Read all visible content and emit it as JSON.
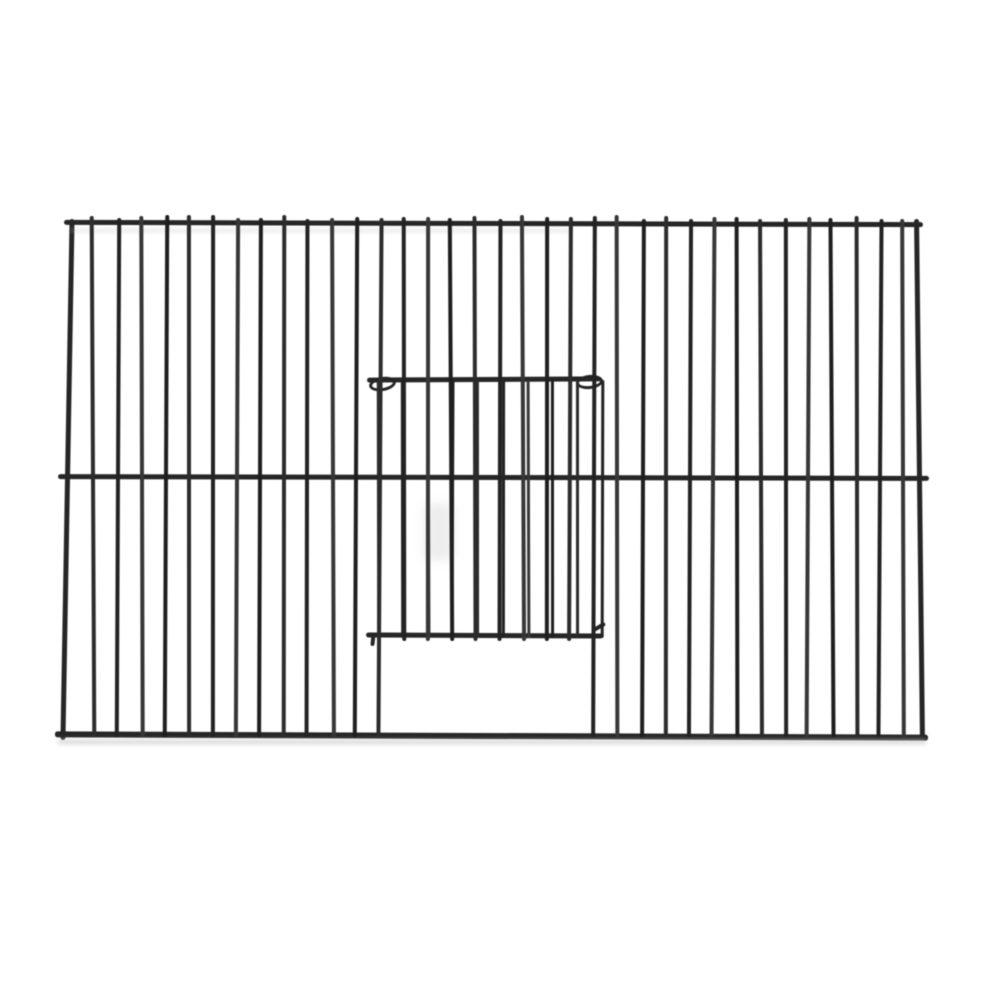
{
  "scene": {
    "description": "Black powder-coated wire bird cage front panel with sliding door, product photo on plain white background",
    "background": "#ffffff",
    "wire_palette": [
      "#1f1f1f",
      "#2c2c2c",
      "#232323",
      "#373737"
    ],
    "shadow_color": "#c9c9c9",
    "ghost_color": "#b5b5b5",
    "patch_color": "#dcdcdc"
  },
  "cage": {
    "top_rail": {
      "x": 64,
      "y": 221,
      "w": 859,
      "h": 5,
      "rot": 0.15
    },
    "bottom_rail": {
      "x": 55,
      "y": 733,
      "w": 873,
      "h": 6,
      "rot": 0.22
    },
    "left_frame": {
      "x": 65,
      "y": 219,
      "w": 5,
      "h": 521,
      "rot": 1.0
    },
    "right_frame": {
      "x": 917,
      "y": 219,
      "w": 5,
      "h": 521,
      "rot": -0.65
    },
    "mid_rail": {
      "x": 58,
      "y": 475,
      "w": 871,
      "h": 5,
      "rot": 0.12
    },
    "bars": {
      "count": 37,
      "x0": 68,
      "pitch": 23.83,
      "top": 217,
      "bottom": 737,
      "w": 4,
      "door_left_index": 13,
      "door_right_index": 22,
      "door_stop_y": 641
    },
    "door": {
      "top_rail": {
        "x": 367,
        "y": 377,
        "w": 234,
        "h": 5,
        "rot": -0.3
      },
      "bottom_rail": {
        "x": 366,
        "y": 633,
        "w": 237,
        "h": 5,
        "rot": 0.25
      },
      "hook_left": {
        "x": 369,
        "y": 377,
        "w": 21,
        "h": 8,
        "rot": -10
      },
      "hook_right": {
        "x": 576,
        "y": 375,
        "w": 21,
        "h": 8,
        "rot": -6
      },
      "bottom_hook_right": {
        "x": 592,
        "y": 625,
        "w": 14,
        "h": 4,
        "rot": -30
      },
      "bottom_hook_left": {
        "x": 371,
        "y": 633,
        "w": 4,
        "h": 13,
        "rot": 6
      },
      "wires": {
        "count": 10,
        "x0": 377,
        "pitch": 24.9,
        "top": 380,
        "bottom": 638,
        "w": 3.4
      },
      "opening": {
        "x": 381,
        "y": 641,
        "w": 209,
        "h": 92
      }
    },
    "shadow": {
      "x": 58,
      "y": 740,
      "w": 868,
      "h": 4
    },
    "ghost_line": {
      "x": 70,
      "y": 229,
      "w": 500,
      "h": 3
    },
    "pale_patch": {
      "x": 424,
      "y": 504,
      "w": 30,
      "h": 56
    }
  }
}
